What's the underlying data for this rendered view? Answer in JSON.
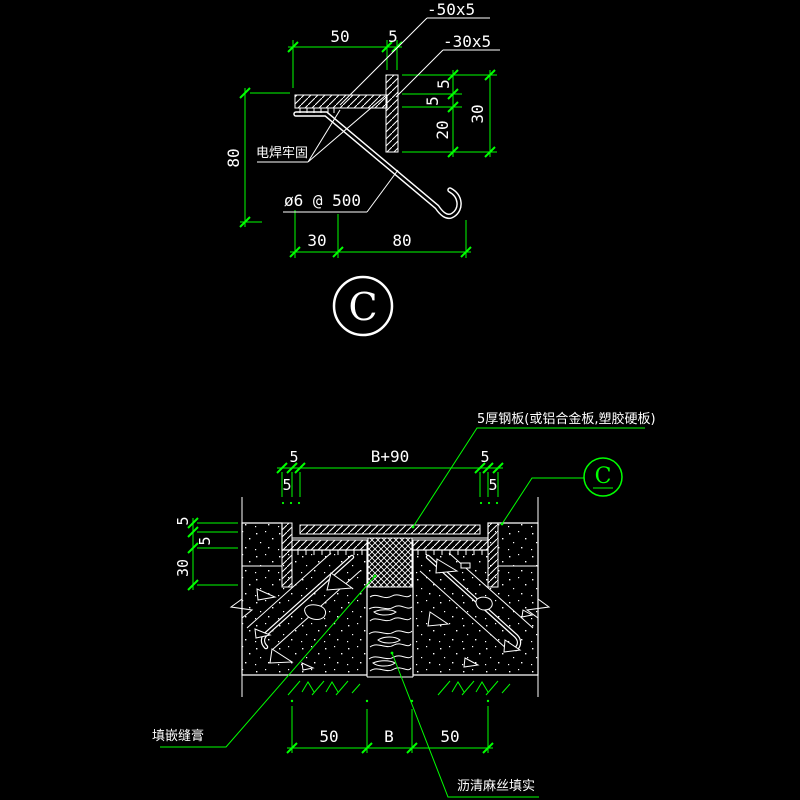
{
  "colors": {
    "background": "#000000",
    "drawing_line": "#ffffff",
    "dimension": "#00ff00"
  },
  "detail_top": {
    "marker": "C",
    "labels": {
      "plate_flat": "-50x5",
      "plate_upright": "-30x5",
      "weld": "电焊牢固",
      "anchor_bar": "ø6 @ 500"
    },
    "dims": {
      "top_width": "50",
      "top_thk": "5",
      "left_height": "80",
      "right_lip": "5",
      "right_thk": "5",
      "right_below": "20",
      "right_total": "30",
      "bottom_offset": "30",
      "bottom_reach": "80"
    }
  },
  "section": {
    "marker": "C",
    "labels": {
      "cover_plate": "5厚钢板(或铝合金板,塑胶硬板)",
      "sealant": "填嵌缝膏",
      "oakum": "沥清麻丝填实"
    },
    "dims": {
      "top_left_outer": "5",
      "top_left_inner": "5",
      "top_span": "B+90",
      "top_right_inner": "5",
      "top_right_outer": "5",
      "left_plate": "5",
      "left_bed": "5",
      "left_leg": "30",
      "bottom_left": "50",
      "bottom_gap": "B",
      "bottom_right": "50"
    }
  }
}
